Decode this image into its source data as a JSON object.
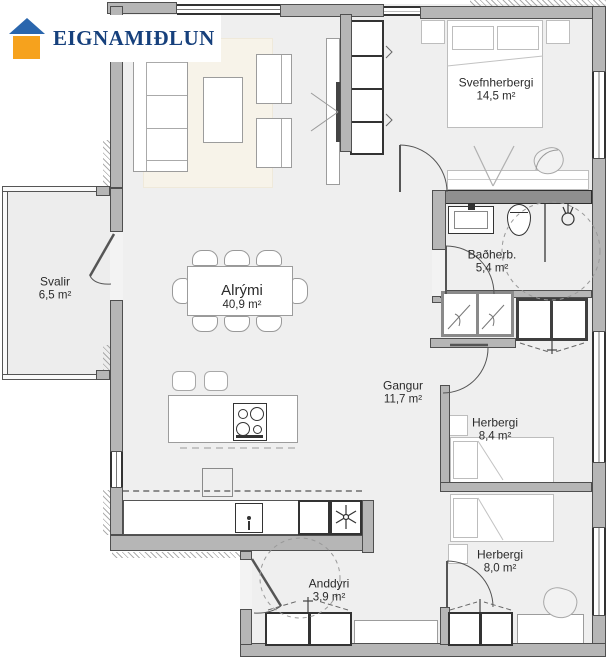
{
  "brand": {
    "name": "EIGNAMIÐLUN"
  },
  "colors": {
    "wall": "#b6b6b6",
    "wall_outline": "#4f4f4f",
    "floor": "#efefef",
    "rug": "#f7f3e9",
    "logo_roof": "#2a66ad",
    "logo_house": "#f6a21d",
    "logo_text": "#16407c"
  },
  "icons": {
    "freezer_star": "snowflake-icon",
    "shower": "shower-head-icon",
    "cooktop": "cooktop-icon",
    "sink": "sink-icon",
    "toilet": "toilet-icon"
  },
  "rooms": {
    "svefnherbergi": {
      "name": "Svefnherbergi",
      "area": "14,5 m²"
    },
    "badherbergi": {
      "name": "Baðherb.",
      "area": "5,4 m²"
    },
    "svalir": {
      "name": "Svalir",
      "area": "6,5 m²"
    },
    "alrymi": {
      "name": "Alrými",
      "area": "40,9 m²"
    },
    "gangur": {
      "name": "Gangur",
      "area": "11,7 m²"
    },
    "herbergi_84": {
      "name": "Herbergi",
      "area": "8,4 m²"
    },
    "herbergi_80": {
      "name": "Herbergi",
      "area": "8,0 m²"
    },
    "anddyri": {
      "name": "Anddyri",
      "area": "3,9 m²"
    }
  }
}
